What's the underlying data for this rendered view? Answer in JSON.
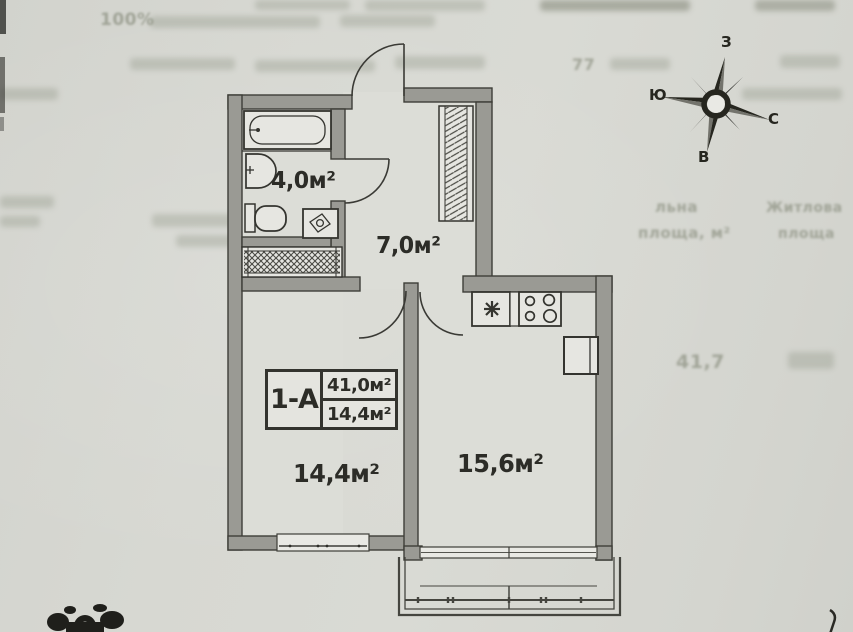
{
  "plan": {
    "unit_code": "1-А",
    "unit_total_area": "41,0м²",
    "unit_living_area": "14,4м²",
    "rooms": [
      {
        "name": "bathroom",
        "area": "4,0м²"
      },
      {
        "name": "hallway",
        "area": "7,0м²"
      },
      {
        "name": "living-room",
        "area": "14,4м²"
      },
      {
        "name": "kitchen-living-room",
        "area": "15,6м²"
      }
    ]
  },
  "compass": {
    "top": "З",
    "left": "Ю",
    "right": "С",
    "bottom": "В"
  },
  "bleed_through": {
    "percent": "100%",
    "number": "77",
    "col_mid_line1": "льна",
    "col_mid_line2": "площа, м²",
    "col_right_line1": "Житлова",
    "col_right_line2": "площа",
    "value": "41,7"
  },
  "colors": {
    "paper": "#d6d7d1",
    "wall_fill": "#9a9a94",
    "line": "#3c3c37",
    "text": "#2c2c27"
  }
}
